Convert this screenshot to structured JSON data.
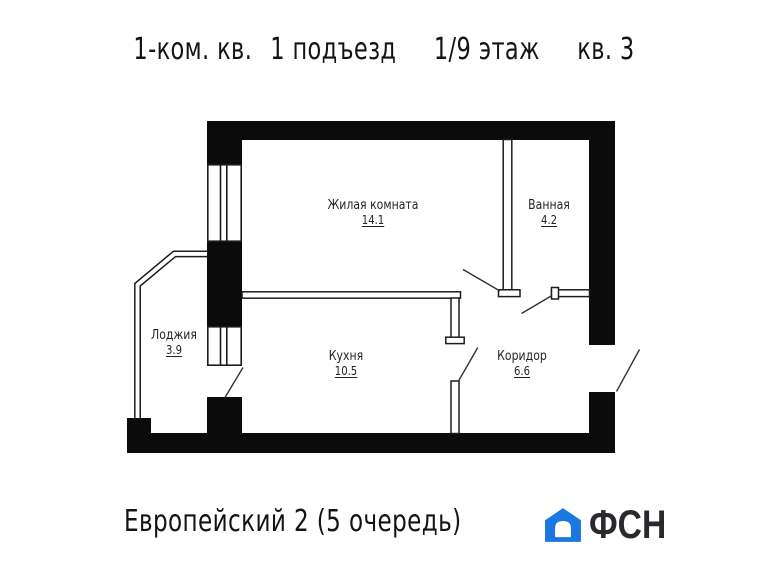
{
  "header": {
    "title_parts": [
      "1-ком. кв.",
      "1 подъезд",
      "1/9 этаж",
      "кв. 3"
    ]
  },
  "rooms": [
    {
      "name": "Жилая комната",
      "area": "14.1"
    },
    {
      "name": "Ванная",
      "area": "4.2"
    },
    {
      "name": "Лоджия",
      "area": "3.9"
    },
    {
      "name": "Кухня",
      "area": "10.5"
    },
    {
      "name": "Коридор",
      "area": "6.6"
    }
  ],
  "footer": {
    "project": "Европейский 2 (5 очередь)",
    "logo_text": "ФСН"
  },
  "colors": {
    "wall": "#0b0b0b",
    "thin_line": "#1d1d1d",
    "door_line": "#333333",
    "logo_blue": "#1b78e0",
    "text": "#242424"
  }
}
